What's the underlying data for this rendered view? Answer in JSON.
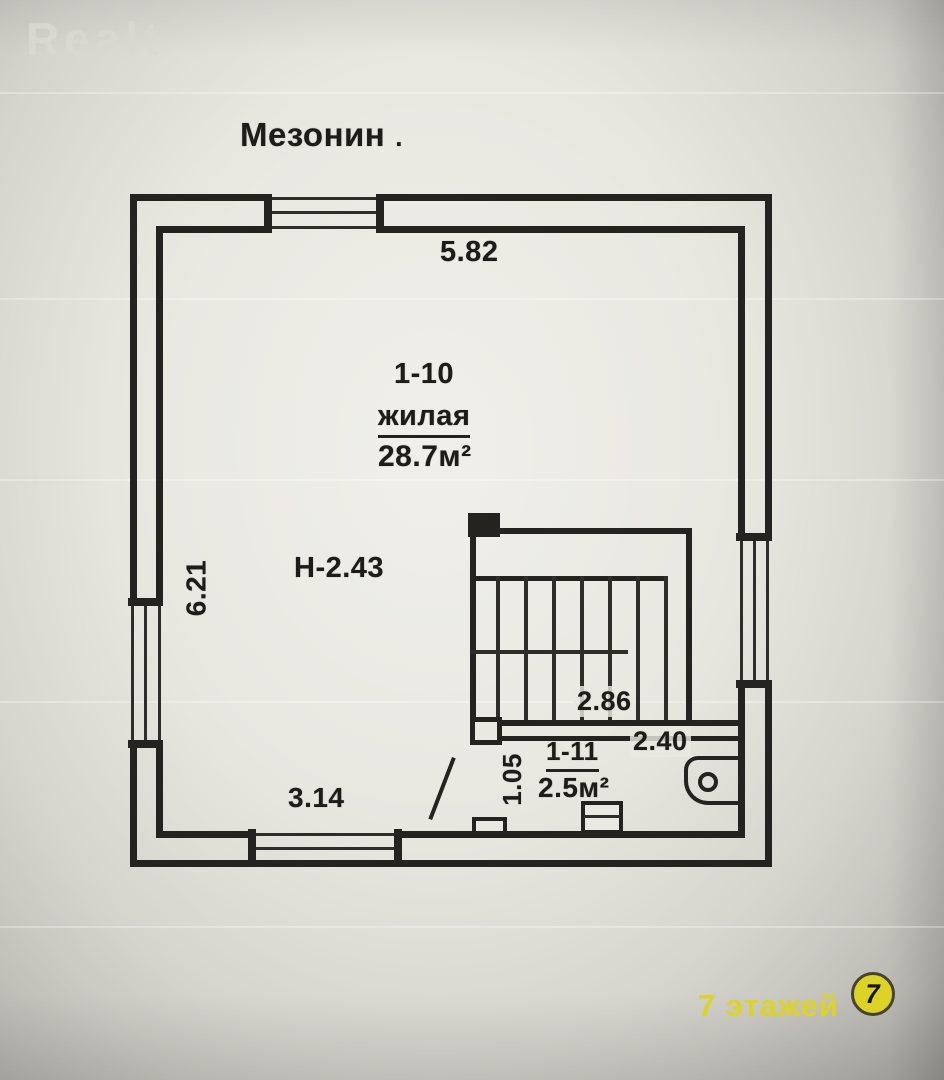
{
  "watermark": "Realt",
  "title": {
    "text": "Мезонин",
    "suffix": "."
  },
  "plan": {
    "floor_height": "Н-2.43",
    "dimensions": {
      "top_width": "5.82",
      "left_height": "6.21",
      "bottom_width": "3.14",
      "stair_width": "2.86",
      "landing_width": "2.40",
      "room2_depth": "1.05"
    },
    "rooms": [
      {
        "number": "1-10",
        "name": "жилая",
        "area": "28.7м²"
      },
      {
        "number": "1-11",
        "area": "2.5м²"
      }
    ]
  },
  "footer": {
    "floors_text": "7 этажей",
    "badge_number": "7"
  },
  "colors": {
    "accent_yellow": "#dcd326",
    "ink": "#24231f",
    "paper": "#e9e8e1"
  }
}
